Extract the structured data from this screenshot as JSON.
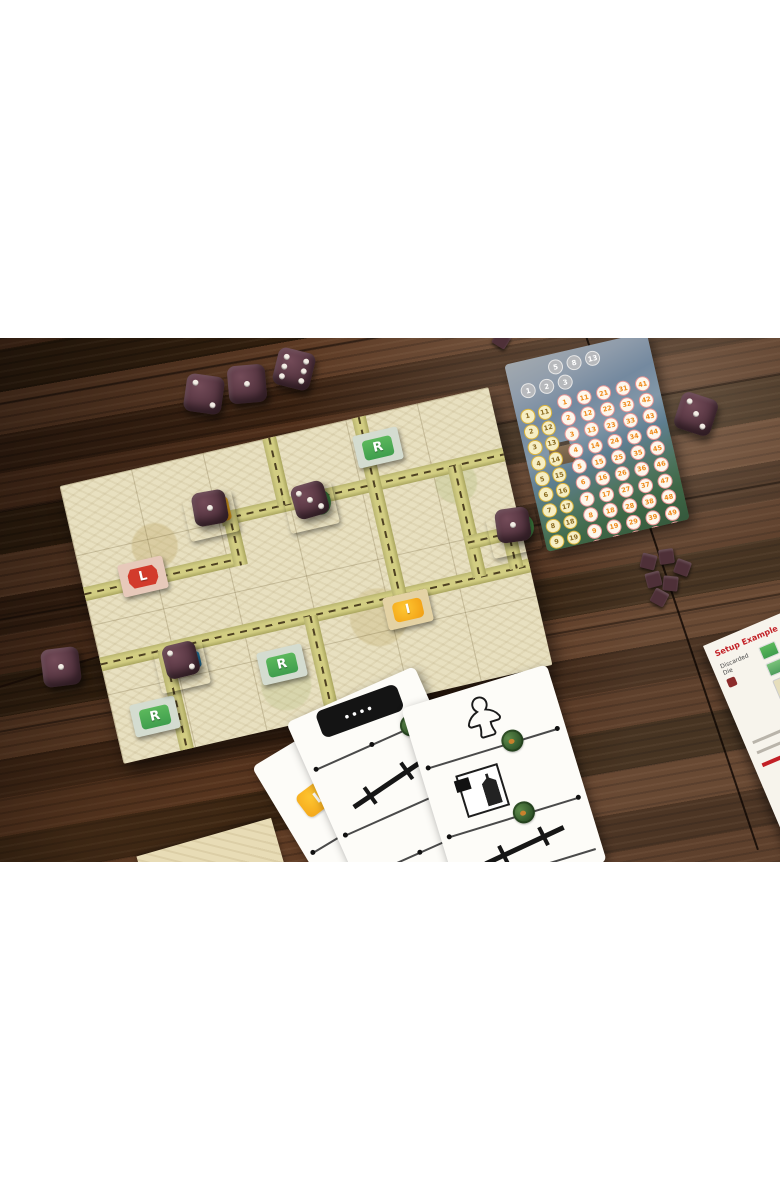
{
  "alt": "Railway board game photographed on a dark wood table",
  "colors": {
    "wood": "#46281a",
    "die_body": "#55323e",
    "die_pip": "#f3ede5",
    "board_tile": "#e8e0c0",
    "road": "#d2cd82",
    "badge_red": "#d23b2c",
    "badge_green": "#3f9e4d",
    "badge_orange": "#f09c12",
    "stamp_green": "#33582c",
    "rules_red": "#c22026"
  },
  "board": {
    "letter_tiles": [
      {
        "id": "red-L",
        "letter": "L"
      },
      {
        "id": "green-R-top",
        "letter": "R"
      },
      {
        "id": "green-R-middle",
        "letter": "R"
      },
      {
        "id": "green-R-bottom",
        "letter": "R"
      },
      {
        "id": "orange-I",
        "letter": "I"
      }
    ]
  },
  "dice": {
    "table": [
      {
        "id": "top-row-left",
        "top": 2
      },
      {
        "id": "top-row-middle",
        "top": 1
      },
      {
        "id": "top-row-right",
        "top": 6
      },
      {
        "id": "left-edge",
        "top": 1
      },
      {
        "id": "right-of-pad",
        "top": 3
      }
    ],
    "on_board": [
      {
        "id": "on-flag-tile",
        "top": 1
      },
      {
        "id": "on-green-tile",
        "top": 3
      },
      {
        "id": "on-right-green-tile",
        "top": 1
      },
      {
        "id": "on-blue-tile",
        "top": 2
      }
    ]
  },
  "score_pad": {
    "gray_upper": [
      "5",
      "8",
      "13"
    ],
    "gray_lower": [
      "1",
      "2",
      "3"
    ],
    "yellow_columns": [
      [
        "1",
        "2",
        "3",
        "4",
        "5",
        "6",
        "7",
        "8",
        "9",
        "10"
      ],
      [
        "11",
        "12",
        "13",
        "14",
        "15",
        "16",
        "17",
        "18",
        "19",
        "20"
      ]
    ],
    "orange_columns": [
      [
        "1",
        "2",
        "3",
        "4",
        "5",
        "6",
        "7",
        "8",
        "9",
        "10"
      ],
      [
        "11",
        "12",
        "13",
        "14",
        "15",
        "16",
        "17",
        "18",
        "19",
        "20"
      ],
      [
        "21",
        "22",
        "23",
        "24",
        "25",
        "26",
        "27",
        "28",
        "29",
        "30"
      ],
      [
        "31",
        "32",
        "33",
        "34",
        "35",
        "36",
        "37",
        "38",
        "39",
        "40"
      ],
      [
        "41",
        "42",
        "43",
        "44",
        "45",
        "46",
        "47",
        "48",
        "49",
        "50"
      ]
    ]
  },
  "cards": {
    "badge_letter": "I",
    "icons": [
      "meeple",
      "building-photo",
      "track-segment",
      "train-car",
      "green-stamp",
      "double-track"
    ]
  },
  "rules_sheet": {
    "heading": "Setup Example",
    "caption": "Discarded Die"
  },
  "cubes_count": 6
}
